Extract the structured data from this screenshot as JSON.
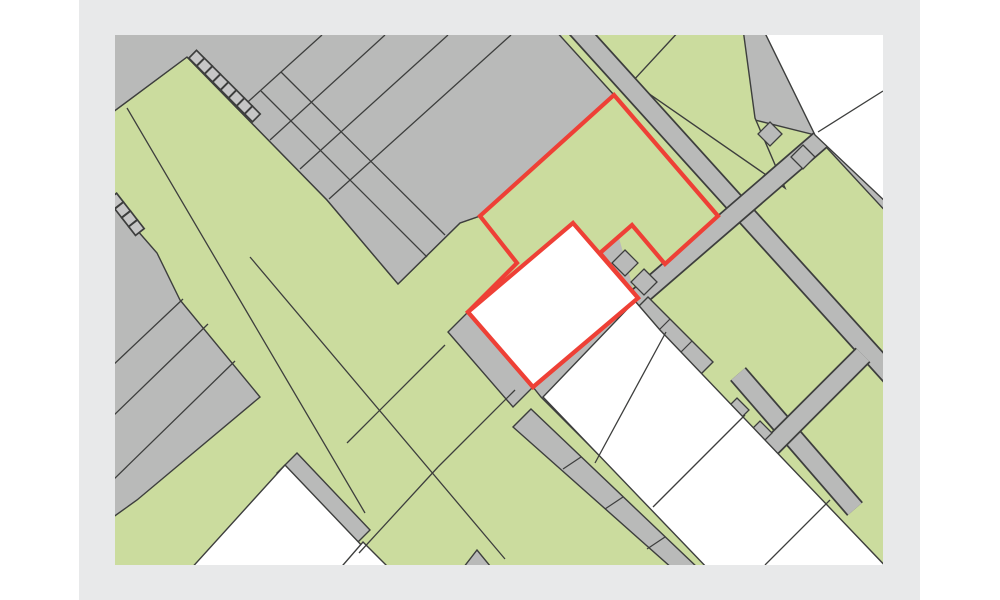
{
  "app": {
    "type": "cadastral-parcel-map-viewer",
    "description": "Cadastral map extract with a red highlighted parcel and highlighted building footprint. No visible text labels."
  },
  "palette": {
    "page_bg": "#ffffff",
    "frame_bg": "#e8e9ea",
    "gray": "#b9bab9",
    "green": "#cbdc9e",
    "white": "#ffffff",
    "line": "#3d3e3d",
    "red": "#ee4036",
    "box_fill": "#c6c6c6"
  },
  "canvas": {
    "page_w": 1000,
    "page_h": 600,
    "frame_x": 79,
    "frame_w": 841,
    "map_x": 115,
    "map_y": 35,
    "map_w": 768,
    "map_h": 530
  },
  "map_layers": [
    {
      "t": "poly",
      "name": "map-base-gray",
      "pts": "-6,-6 774,-6 774,536 -6,536",
      "fill": "gray"
    },
    {
      "t": "poly",
      "name": "green-area-west",
      "pts": "72,22 212,165 283,249 345,188 365,181 402,228 373,275 418,352 426,362 596,532 598,537 -6,537 -6,80",
      "fill": "green",
      "stroke": "line",
      "sw": 1.4
    },
    {
      "t": "poly",
      "name": "green-area-east",
      "pts": "445,-6 774,-6 774,536 598,536",
      "fill": "green"
    },
    {
      "t": "poly",
      "name": "gray-block-topleft-grid",
      "pts": "-6,-6 439,-6 499,60 365,181 345,188 283,249 212,165 72,22 -6,80",
      "fill": "gray",
      "stroke": "line",
      "sw": 1.4
    },
    {
      "t": "lines",
      "name": "grid-parcel-lines",
      "stroke": "line",
      "sw": 1.3,
      "segs": [
        [
          207,
          0,
          125,
          74
        ],
        [
          270,
          0,
          155,
          105
        ],
        [
          333,
          0,
          185,
          134
        ],
        [
          396,
          0,
          214,
          164
        ],
        [
          146,
          56,
          312,
          222
        ],
        [
          166,
          37,
          330,
          200
        ]
      ]
    },
    {
      "t": "poly",
      "name": "gray-block-lowerleft",
      "pts": "-6,163 42,218 65,265 145,362 22,465 -6,485",
      "fill": "gray",
      "stroke": "line",
      "sw": 1.4
    },
    {
      "t": "lines",
      "name": "lowerleft-parcel-lines",
      "stroke": "line",
      "sw": 1.3,
      "segs": [
        [
          -4,
          332,
          68,
          264
        ],
        [
          -4,
          383,
          93,
          289
        ],
        [
          -4,
          447,
          120,
          326
        ]
      ]
    },
    {
      "t": "poly",
      "name": "gray-block-topright",
      "pts": "560,-6 774,-6 774,180 700,100 640,85 564,0",
      "fill": "gray",
      "stroke": "line",
      "sw": 1.4
    },
    {
      "t": "poly",
      "name": "green-parcel-topright",
      "pts": "517,47 566,-6 628,-6 640,83 670,153",
      "fill": "green",
      "stroke": "line",
      "sw": 1.4
    },
    {
      "t": "road",
      "name": "road-northeast",
      "x1": 459,
      "y1": -10,
      "x2": 779,
      "y2": 344,
      "w": 21,
      "wi": 17.5
    },
    {
      "t": "road",
      "name": "road-cross-upper",
      "x1": 776,
      "y1": 44,
      "x2": 519,
      "y2": 266,
      "w": 21,
      "wi": 17.5
    },
    {
      "t": "road",
      "name": "road-lower-diagonal",
      "x1": 623,
      "y1": 339,
      "x2": 740,
      "y2": 474,
      "w": 21,
      "wi": 17.5
    },
    {
      "t": "road",
      "name": "road-lower-cross",
      "x1": 748,
      "y1": 320,
      "x2": 600,
      "y2": 468,
      "w": 21,
      "wi": 17.5
    },
    {
      "t": "poly",
      "name": "garage-row-east",
      "pts": "533,262 598,327 584,341 519,276",
      "fill": "gray",
      "stroke": "line",
      "sw": 1.4
    },
    {
      "t": "lines",
      "name": "garage-row-east-dividers",
      "stroke": "line",
      "sw": 1.2,
      "segs": [
        [
          555,
          284,
          541,
          298
        ],
        [
          577,
          306,
          563,
          320
        ]
      ]
    },
    {
      "t": "poly",
      "name": "garage-band-halls",
      "pts": "416,374 584,534 558,534 398,392",
      "fill": "gray",
      "stroke": "line",
      "sw": 1.4
    },
    {
      "t": "lines",
      "name": "garage-band-dividers",
      "stroke": "line",
      "sw": 1.2,
      "segs": [
        [
          466,
          422,
          448,
          434
        ],
        [
          508,
          462,
          490,
          474
        ],
        [
          550,
          502,
          532,
          514
        ]
      ]
    },
    {
      "t": "poly",
      "name": "gray-parcel-beside-building",
      "pts": "353,277 418,352 398,372 333,297",
      "fill": "gray",
      "stroke": "line",
      "sw": 1.4
    },
    {
      "t": "poly",
      "name": "small-parcel-notch-a",
      "pts": "510,215 523,228 510,241 497,228",
      "fill": "gray",
      "stroke": "line",
      "sw": 1.3
    },
    {
      "t": "poly",
      "name": "small-parcel-notch-b",
      "pts": "529,234 542,247 529,260 516,247",
      "fill": "gray",
      "stroke": "line",
      "sw": 1.3
    },
    {
      "t": "poly",
      "name": "small-parcel-topright-a",
      "pts": "655,87 667,99 655,111 643,99",
      "fill": "gray",
      "stroke": "line",
      "sw": 1.3
    },
    {
      "t": "poly",
      "name": "small-parcel-topright-b",
      "pts": "688,110 700,122 688,134 676,122",
      "fill": "gray",
      "stroke": "line",
      "sw": 1.3
    },
    {
      "t": "poly",
      "name": "small-parcel-crossing-a",
      "pts": "622,363 634,375 622,387 610,375",
      "fill": "gray",
      "stroke": "line",
      "sw": 1.3
    },
    {
      "t": "poly",
      "name": "small-parcel-crossing-b",
      "pts": "645,386 657,398 645,410 633,398",
      "fill": "gray",
      "stroke": "line",
      "sw": 1.3
    },
    {
      "t": "poly",
      "name": "gray-parcel-bottomleft",
      "pts": "182,418 255,495 235,515 162,438",
      "fill": "gray",
      "stroke": "line",
      "sw": 1.4
    },
    {
      "t": "poly",
      "name": "gray-wedge-bottom",
      "pts": "345,537 362,515 380,537",
      "fill": "gray",
      "stroke": "line",
      "sw": 1.4
    },
    {
      "t": "poly",
      "name": "white-parcel-topright",
      "pts": "648,-6 774,-6 774,170 700,100",
      "fill": "white",
      "stroke": "line",
      "sw": 1.4
    },
    {
      "t": "lines",
      "name": "white-topright-divider",
      "stroke": "line",
      "sw": 1.3,
      "segs": [
        [
          703,
          97,
          768,
          56
        ]
      ]
    },
    {
      "t": "poly",
      "name": "white-halls-row",
      "pts": "520,266 545,295 777,538 596,537 428,362",
      "fill": "white",
      "stroke": "line",
      "sw": 1.4
    },
    {
      "t": "lines",
      "name": "halls-dividers",
      "stroke": "line",
      "sw": 1.3,
      "segs": [
        [
          551,
          297,
          480,
          428
        ],
        [
          630,
          380,
          538,
          472
        ],
        [
          715,
          465,
          650,
          530
        ]
      ]
    },
    {
      "t": "poly",
      "name": "white-parcel-bottomleft",
      "pts": "170,430 272,537 73,537",
      "fill": "white",
      "stroke": "line",
      "sw": 1.4
    },
    {
      "t": "poly",
      "name": "white-parcel-bottomleft-b",
      "pts": "248,507 278,537 222,537",
      "fill": "white",
      "stroke": "line",
      "sw": 1.4
    },
    {
      "t": "lines",
      "name": "green-parcel-boundary-lines",
      "stroke": "line",
      "sw": 1.3,
      "segs": [
        [
          12,
          73,
          250,
          478
        ],
        [
          135,
          222,
          390,
          524
        ],
        [
          232,
          408,
          330,
          310
        ],
        [
          323,
          432,
          400,
          355
        ],
        [
          244,
          518,
          323,
          432
        ]
      ]
    },
    {
      "t": "ladder",
      "name": "garage-ladder-northwest",
      "start": [
        72,
        22
      ],
      "dir": [
        0.707,
        0.707
      ],
      "perp": [
        0.707,
        -0.707
      ],
      "count": 8,
      "size": 11,
      "step": 11.3,
      "t0": 2,
      "off": 0.5,
      "fill": "box_fill",
      "stroke": "line",
      "sw": 1.7
    },
    {
      "t": "ladder",
      "name": "garage-ladder-west",
      "start": [
        -4,
        160
      ],
      "dir": [
        0.615,
        0.789
      ],
      "perp": [
        0.789,
        -0.615
      ],
      "count": 4,
      "size": 11,
      "step": 11.3,
      "t0": 2,
      "off": -5.5,
      "fill": "box_fill",
      "stroke": "line",
      "sw": 1.7
    },
    {
      "t": "poly",
      "name": "highlighted-parcel",
      "pts": "499,60 603,181 550,229 517,190 485,218 523,263 418,352 353,277 402,228 365,181",
      "fill": "green",
      "stroke": "red",
      "sw": 4.2
    },
    {
      "t": "poly",
      "name": "highlighted-building",
      "pts": "458,188 523,263 418,352 353,277",
      "fill": "white",
      "stroke": "red",
      "sw": 4.2
    }
  ]
}
